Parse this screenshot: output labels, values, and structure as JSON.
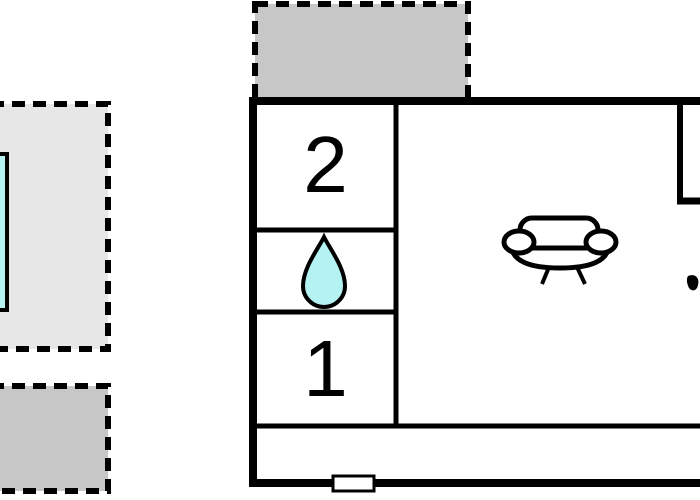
{
  "plan": {
    "title": "holiday-home-floor-plan",
    "rooms": [
      {
        "id": "bedroom-2",
        "label": "2"
      },
      {
        "id": "bathroom",
        "label": "",
        "icon": "water-drop-icon"
      },
      {
        "id": "bedroom-1",
        "label": "1"
      },
      {
        "id": "living-room",
        "label": "",
        "icon": "sofa-icon"
      },
      {
        "id": "corridor",
        "label": ""
      },
      {
        "id": "top-right-room",
        "label": ""
      }
    ],
    "outdoor_areas": [
      {
        "id": "pool-terrace",
        "type": "terrace",
        "contains": "swimming-pool"
      },
      {
        "id": "lower-terrace",
        "type": "terrace"
      },
      {
        "id": "upper-terrace",
        "type": "terrace"
      }
    ],
    "features": [
      {
        "id": "window-bottom",
        "type": "window"
      }
    ],
    "colors": {
      "terrace_light": "#e7e7e7",
      "terrace_dark": "#c7c7c7",
      "water": "#b5f2f2",
      "wall": "#000000",
      "room_fill": "#ffffff"
    }
  }
}
